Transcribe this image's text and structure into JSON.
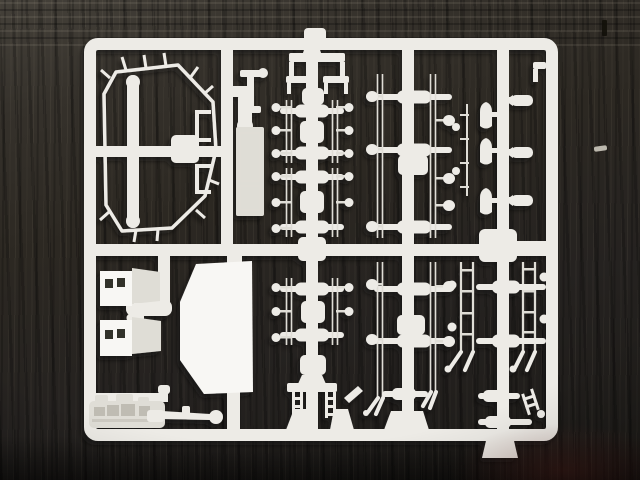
{
  "scene": {
    "type": "photograph",
    "description": "White plastic model-kit sprue (injection-moulded parts tree) lying on a dark wooden table",
    "surface": "dark wood with grain streaks",
    "objects": [
      "rectangular sprue frame with internal runners",
      "octagonal hull-frame part with long beam",
      "periscope part",
      "rectangular hatch plate",
      "rows of suspension spindle parts with thin handrails",
      "bullet-shaped parts",
      "two storage-box parts with rectangular openings",
      "large flat hull side plate",
      "gun assembly with thin barrel and round muzzle",
      "small ladder and bracket parts"
    ]
  },
  "colors": {
    "wood_base": "#2c2822",
    "wood_light_streak": "#4e4537",
    "wood_dark": "#171511",
    "plastic": "#edebe6",
    "plastic_bright": "#f8f7f4",
    "plastic_dim": "#dfddd6",
    "plastic_shadow": "#bfbcb3",
    "box_hole": "#33302a",
    "cast_shadow": "#0b0d12"
  }
}
